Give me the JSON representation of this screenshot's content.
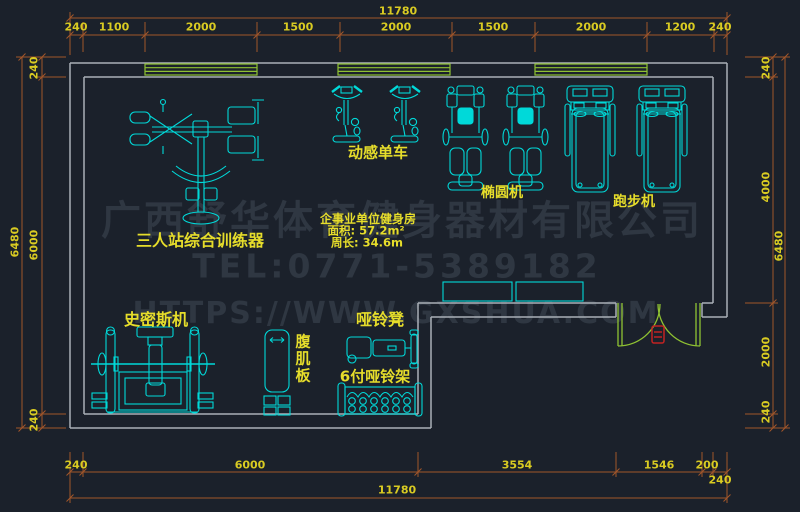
{
  "drawing": {
    "type": "CAD gym floor plan",
    "colors": {
      "background": "#1b212b",
      "wall": "#aab0b8",
      "window_door": "#8fc232",
      "equipment": "#00d9d9",
      "label": "#e6dd2b",
      "dim_line": "#a2562a",
      "dim_text": "#d9cb22",
      "watermark": "#2f3742",
      "door_marker": "#c22222"
    }
  },
  "room_info": {
    "title": "企事业单位健身房",
    "area": "面积: 57.2m²",
    "perimeter": "周长: 34.6m"
  },
  "equipment_labels": {
    "multi_trainer": "三人站综合训练器",
    "spin_bike": "动感单车",
    "elliptical": "椭圆机",
    "treadmill": "跑步机",
    "smith_machine": "史密斯机",
    "ab_board": "腹肌板",
    "dumbbell_bench": "哑铃凳",
    "dumbbell_rack": "6付哑铃架"
  },
  "dims": {
    "top": {
      "total": "11780",
      "segments": [
        "240",
        "1100",
        "2000",
        "1500",
        "2000",
        "1500",
        "2000",
        "1200",
        "240"
      ]
    },
    "bottom": {
      "total": "11780",
      "segments": [
        "240",
        "6000",
        "3554",
        "1546",
        "200",
        "240"
      ]
    },
    "left": {
      "total": "6480",
      "segments": [
        "240",
        "6000",
        "240"
      ]
    },
    "right": {
      "total": "6480",
      "segments": [
        "240",
        "4000",
        "2000",
        "240"
      ]
    }
  },
  "watermark": {
    "line1": "广西舒华体育健身器材有限公司",
    "line2": "TEL:0771-5389182",
    "line3": "HTTPS://WWW.GXSHUA.COM"
  }
}
